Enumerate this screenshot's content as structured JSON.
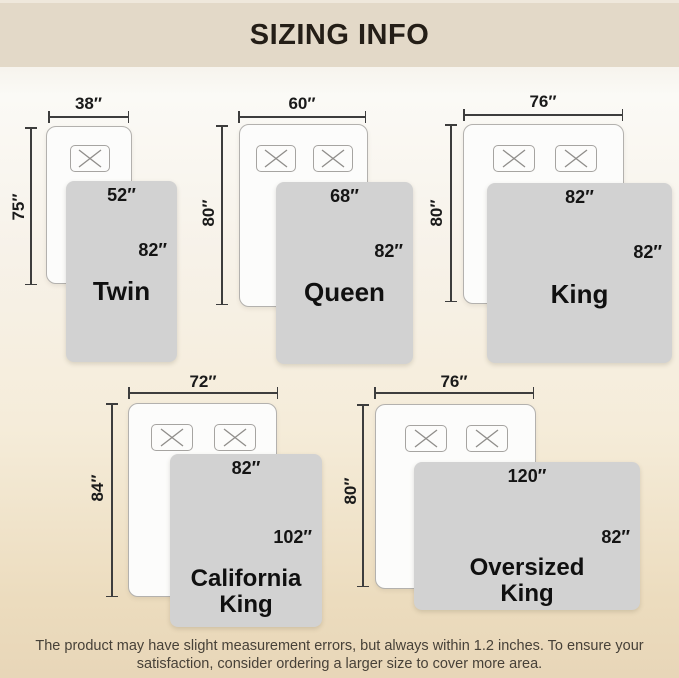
{
  "header": {
    "title": "SIZING INFO"
  },
  "diagrams": [
    {
      "name_lines": [
        "Twin"
      ],
      "mattress_width": "38″",
      "mattress_length": "75″",
      "blanket_width": "52″",
      "blanket_length": "82″"
    },
    {
      "name_lines": [
        "Queen"
      ],
      "mattress_width": "60″",
      "mattress_length": "80″",
      "blanket_width": "68″",
      "blanket_length": "82″"
    },
    {
      "name_lines": [
        "King"
      ],
      "mattress_width": "76″",
      "mattress_length": "80″",
      "blanket_width": "82″",
      "blanket_length": "82″"
    },
    {
      "name_lines": [
        "California",
        "King"
      ],
      "mattress_width": "72″",
      "mattress_length": "84″",
      "blanket_width": "82″",
      "blanket_length": "102″"
    },
    {
      "name_lines": [
        "Oversized",
        "King"
      ],
      "mattress_width": "76″",
      "mattress_length": "80″",
      "blanket_width": "120″",
      "blanket_length": "82″"
    }
  ],
  "footer": {
    "line1": "The product may have slight measurement errors, but always within 1.2 inches. To ensure your",
    "line2": "satisfaction, consider ordering a larger size to cover more area."
  },
  "colors": {
    "header_bg": "#e3d9c8",
    "blanket": "#d2d2d2",
    "background_bottom": "#e8d6b8",
    "text": "#1a1a1a"
  }
}
